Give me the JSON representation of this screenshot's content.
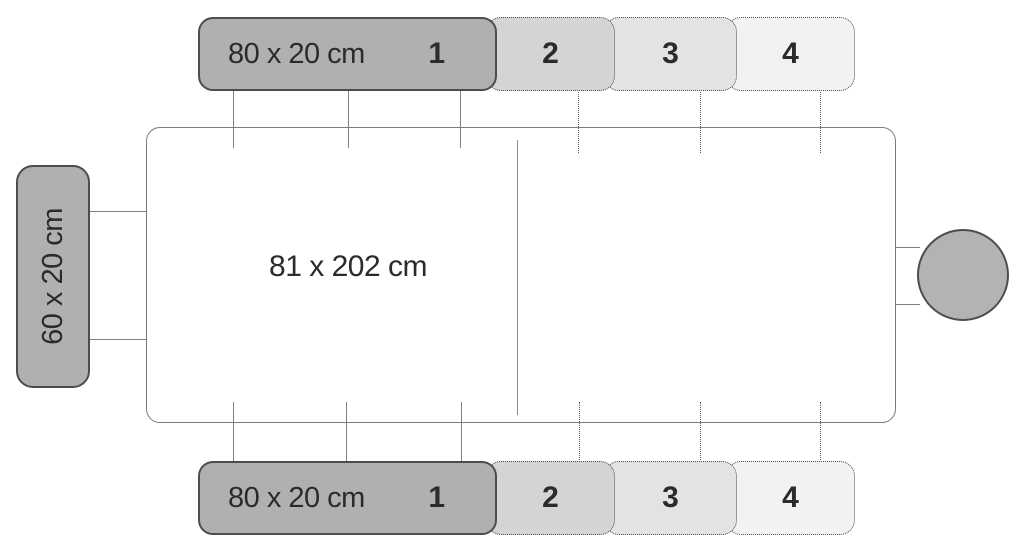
{
  "main_panel": {
    "size_label": "81 x 202 cm"
  },
  "top_extension": {
    "size_label": "80 x 20 cm",
    "segments": [
      {
        "label": "1"
      },
      {
        "label": "2"
      },
      {
        "label": "3"
      },
      {
        "label": "4"
      }
    ]
  },
  "bottom_extension": {
    "size_label": "80 x 20 cm",
    "segments": [
      {
        "label": "1"
      },
      {
        "label": "2"
      },
      {
        "label": "3"
      },
      {
        "label": "4"
      }
    ]
  },
  "side_extension": {
    "size_label": "60 x 20 cm"
  },
  "colors": {
    "segment_1_fill": "#b0b0b0",
    "segment_2_fill": "#d4d4d4",
    "segment_3_fill": "#e3e3e3",
    "segment_4_fill": "#f2f2f2",
    "solid_border": "#4d4d4f",
    "dotted_border": "#4f4f4f",
    "panel_border": "#7a7a7a",
    "connector_line": "#7f7f7f",
    "text": "#2b2b2b",
    "background": "#ffffff"
  }
}
